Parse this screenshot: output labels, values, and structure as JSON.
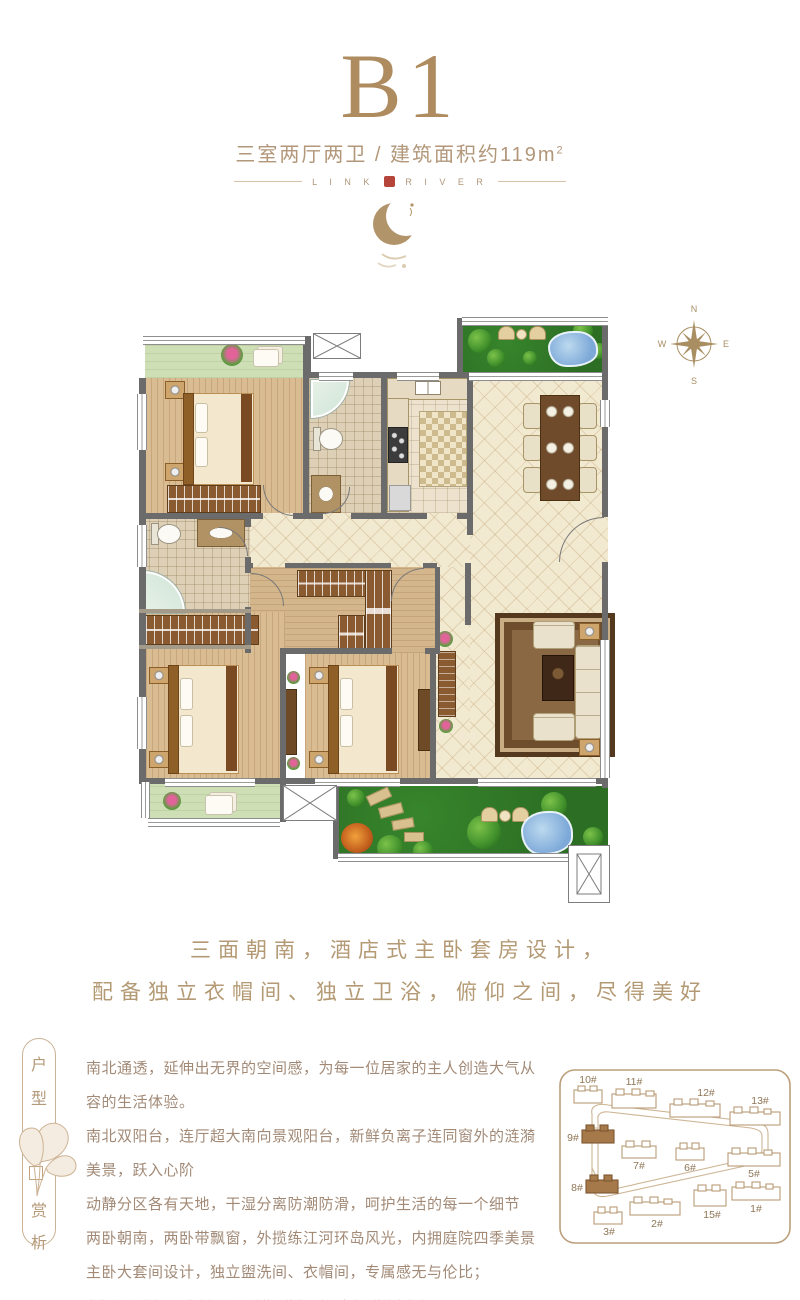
{
  "header": {
    "title": "B1",
    "subtitle_main": "三室两厅两卫 / 建筑面积约119m",
    "subtitle_sup": "2",
    "brand_left": "L I N K",
    "brand_right": "R I V E R"
  },
  "compass": {
    "north": "N",
    "east": "E",
    "south": "S",
    "west": "W"
  },
  "tagline": {
    "line1": "三面朝南，酒店式主卧套房设计，",
    "line2": "配备独立衣帽间、独立卫浴，俯仰之间，尽得美好"
  },
  "banner": {
    "char1": "户",
    "char2": "型",
    "char3": "赏",
    "char4": "析"
  },
  "description": {
    "lines": [
      "南北通透，延伸出无界的空间感，为每一位居家的主人创造大气从容的生活体验。",
      "南北双阳台，连厅超大南向景观阳台，新鲜负离子连同窗外的涟漪美景，跃入心阶",
      "动静分区各有天地，干湿分离防潮防滑，呵护生活的每一个细节",
      "两卧朝南，两卧带飘窗，外揽练江河环岛风光，内拥庭院四季美景",
      "主卧大套间设计，独立盥洗间、衣帽间，专属感无与伦比；"
    ],
    "disclaimer": "本户型图仅供参考，交房标准以最终签署的商品房买卖合同的约定为准。"
  },
  "siteplan": {
    "buildings": [
      {
        "label": "10#"
      },
      {
        "label": "11#"
      },
      {
        "label": "12#"
      },
      {
        "label": "13#"
      },
      {
        "label": "9#"
      },
      {
        "label": "7#"
      },
      {
        "label": "6#"
      },
      {
        "label": "5#"
      },
      {
        "label": "8#"
      },
      {
        "label": "3#"
      },
      {
        "label": "2#"
      },
      {
        "label": "15#"
      },
      {
        "label": "1#"
      }
    ],
    "highlighted": "9#, 8#"
  },
  "colors": {
    "title_gold": "#ae8c60",
    "accent_gold": "#b49a74",
    "text_brown": "#a28a77",
    "seal_red": "#b5443b",
    "wall_gray": "#6b6b6b",
    "garden_green": "#2e7527",
    "balcony_green": "#cedfb6",
    "floor_cream": "#f2e9d1",
    "wood_tan": "#d9bc92",
    "highlight_building": "#a5794a"
  }
}
